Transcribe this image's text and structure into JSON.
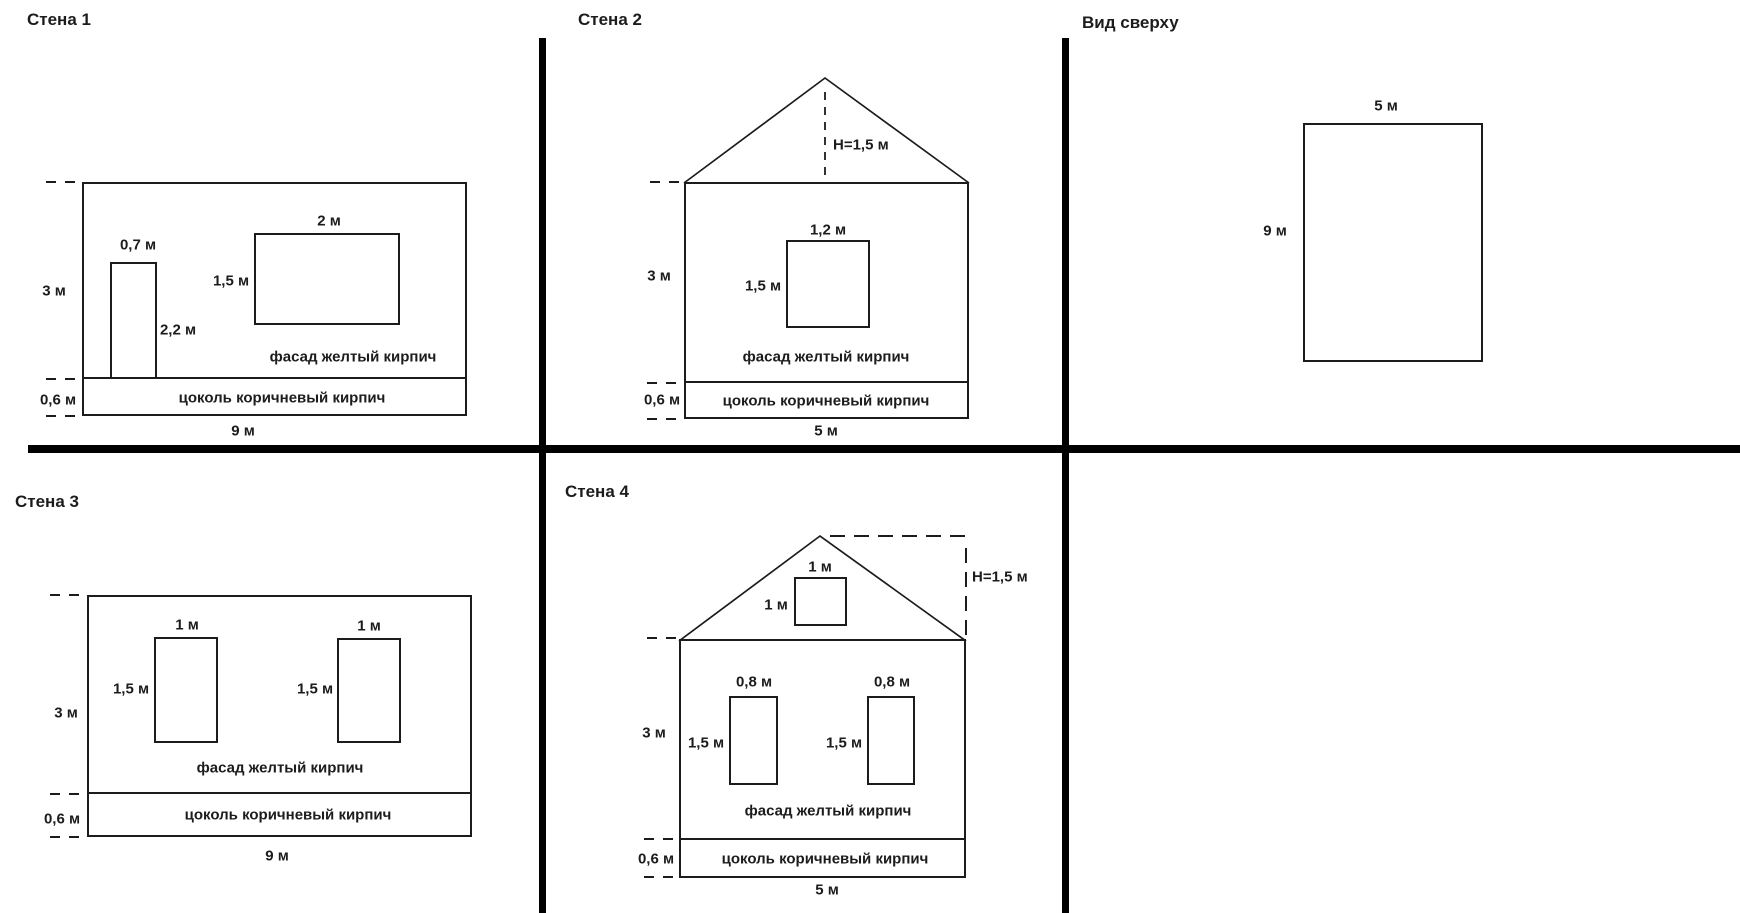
{
  "colors": {
    "line": "#1c1c1c",
    "divider": "#000000",
    "background": "#ffffff"
  },
  "panels": {
    "wall1": {
      "title": "Стена 1",
      "wall_height": "3 м",
      "wall_width": "9 м",
      "plinth_height": "0,6 м",
      "door_width": "0,7 м",
      "door_height": "2,2 м",
      "window_width": "2 м",
      "window_height": "1,5 м",
      "facade_label": "фасад желтый кирпич",
      "plinth_label": "цоколь коричневый кирпич"
    },
    "wall2": {
      "title": "Стена 2",
      "roof_height": "Н=1,5 м",
      "wall_height": "3 м",
      "wall_width": "5 м",
      "plinth_height": "0,6 м",
      "window_width": "1,2 м",
      "window_height": "1,5 м",
      "facade_label": "фасад желтый кирпич",
      "plinth_label": "цоколь коричневый кирпич"
    },
    "top_view": {
      "title": "Вид сверху",
      "width": "5 м",
      "depth": "9 м"
    },
    "wall3": {
      "title": "Стена 3",
      "wall_height": "3 м",
      "wall_width": "9 м",
      "plinth_height": "0,6 м",
      "window1_width": "1 м",
      "window1_height": "1,5 м",
      "window2_width": "1 м",
      "window2_height": "1,5 м",
      "facade_label": "фасад желтый кирпич",
      "plinth_label": "цоколь коричневый кирпич"
    },
    "wall4": {
      "title": "Стена 4",
      "roof_height": "Н=1,5 м",
      "attic_window_width": "1 м",
      "attic_window_height": "1 м",
      "wall_height": "3 м",
      "wall_width": "5 м",
      "plinth_height": "0,6 м",
      "window1_width": "0,8 м",
      "window1_height": "1,5 м",
      "window2_width": "0,8 м",
      "window2_height": "1,5 м",
      "facade_label": "фасад желтый кирпич",
      "plinth_label": "цоколь коричневый кирпич"
    }
  }
}
